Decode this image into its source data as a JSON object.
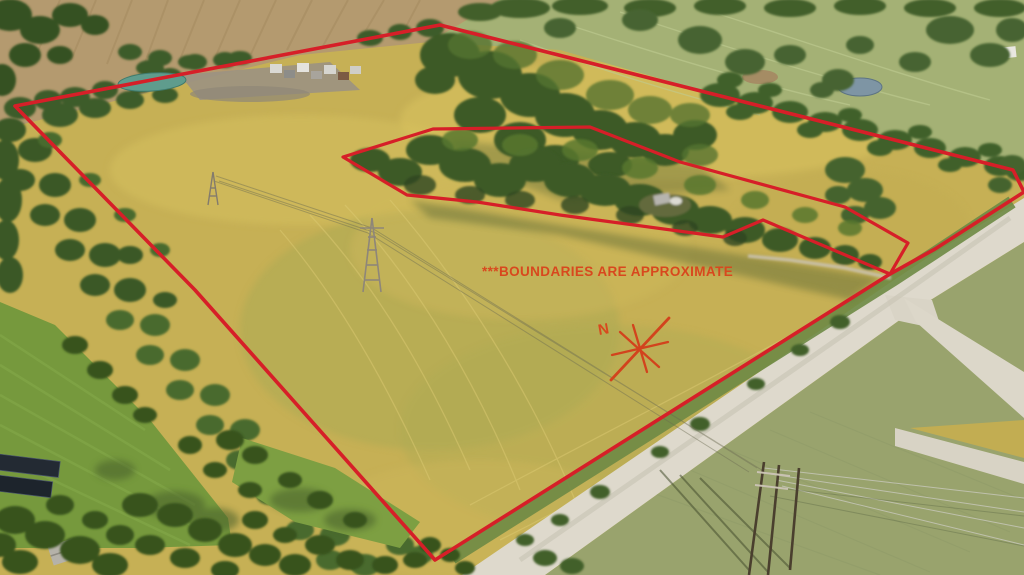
{
  "annotation": {
    "disclaimer": "***BOUNDARIES ARE APPROXIMATE",
    "compass_label": "N",
    "boundary_color": "#d61f28",
    "label_color": "#d8481e",
    "outer_boundary_points": "15,106 440,25 1013,170 1024,192 935,249 890,274 435,560 195,290",
    "inner_boundary_points": "343,157 433,129 590,127 680,162 845,207 908,243 890,274 763,220 723,237 560,215 477,202 407,195"
  },
  "scene": {
    "field_yellow": "#c6b055",
    "pasture_green": "#a4b175",
    "lawn_green": "#76993d",
    "tree_green": "#3e5c29",
    "road_gray": "#ded9cc",
    "pond_blue": "#7e95a4",
    "lagoon_teal": "#5f9c8d"
  }
}
